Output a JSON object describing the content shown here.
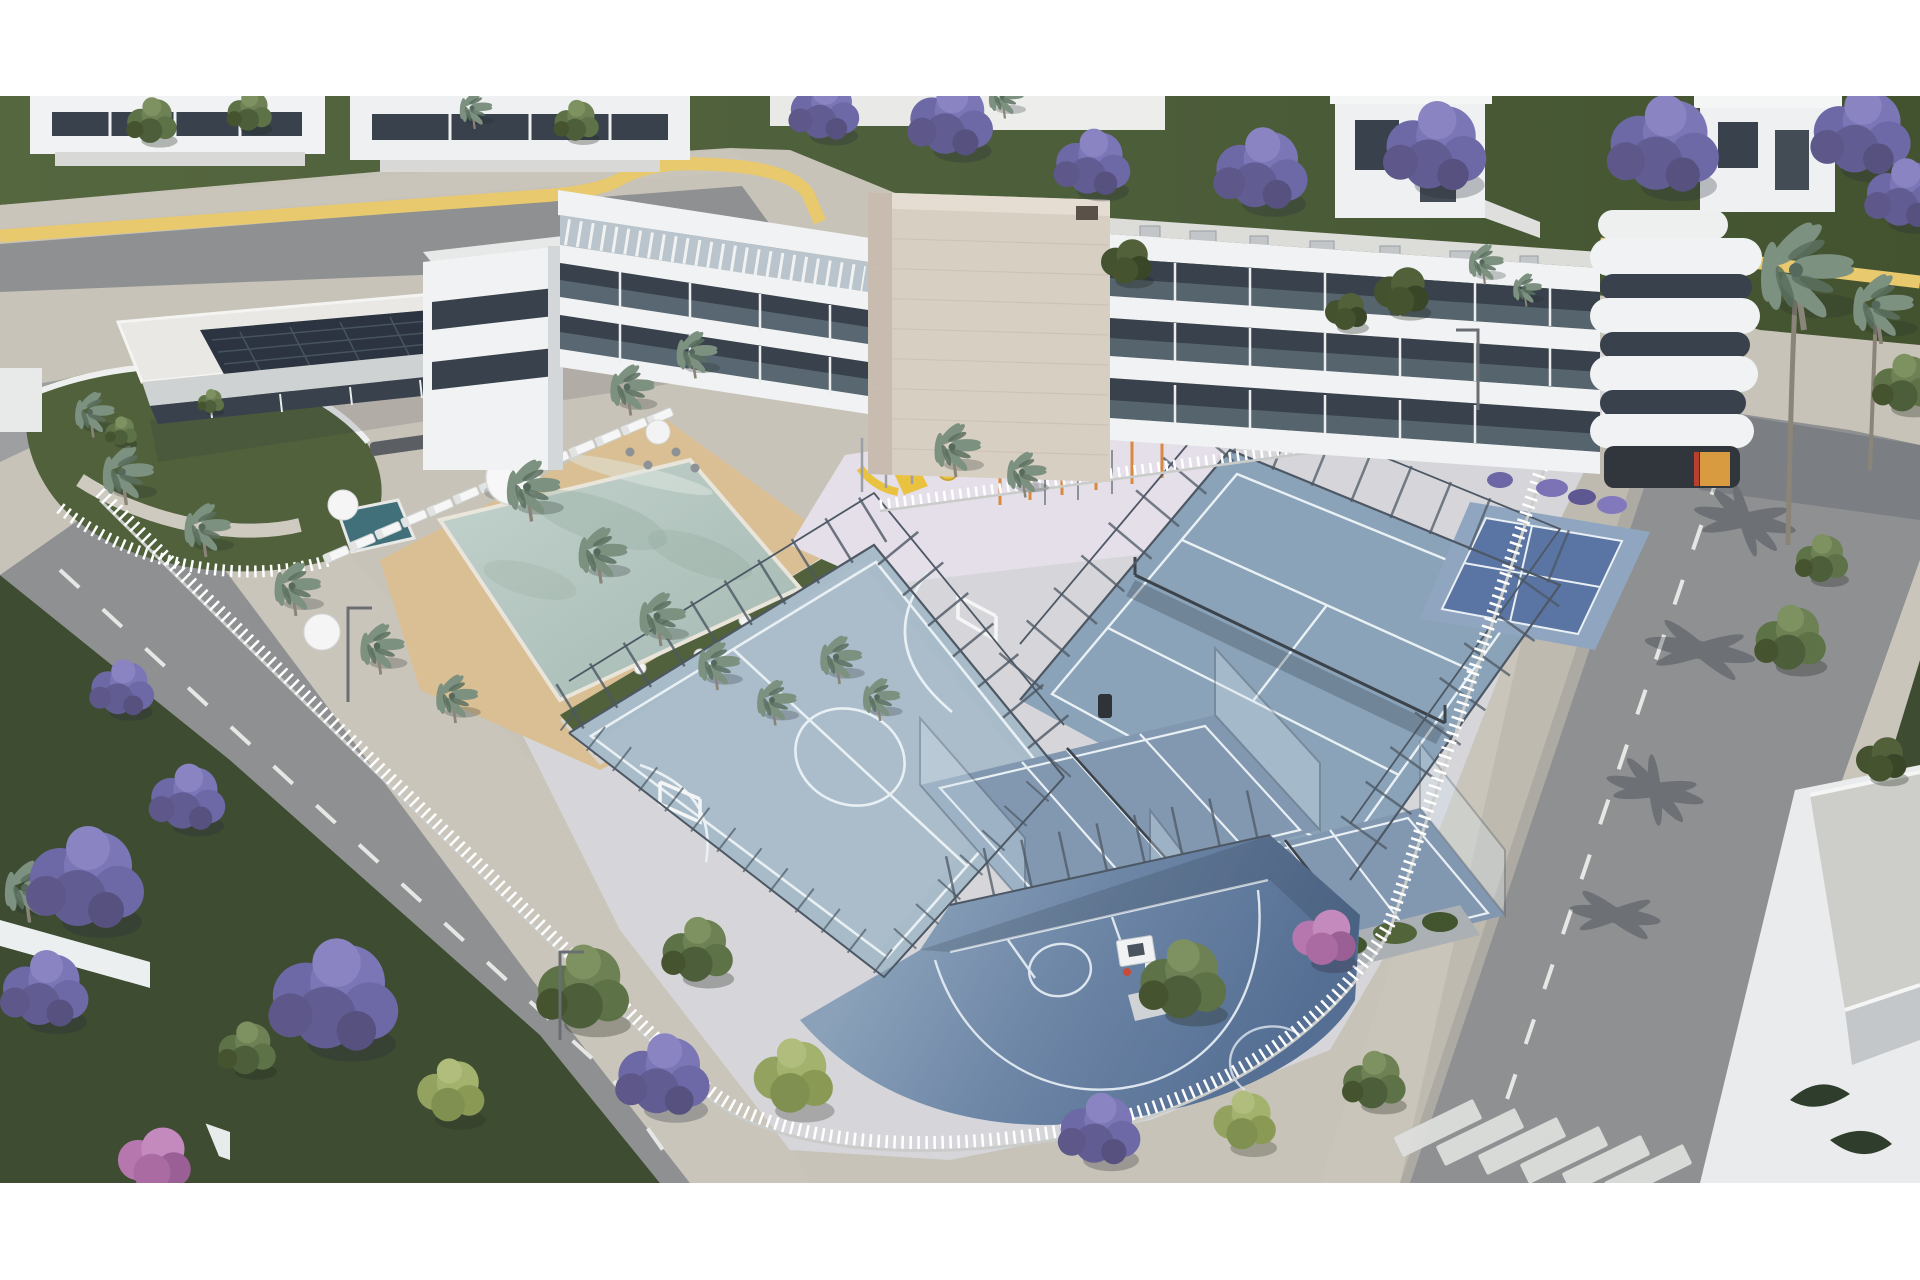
{
  "scene": {
    "description": "Aerial 3D architectural rendering of a modern white residential complex with a central beige stone tower, rooftop solar panels, a landscaped pool garden with palm trees and sun loungers, a playground and outdoor gym, multi-sport courts (futsal, tennis, padel, pickleball, basketball), perimeter white fences, and surrounding streets lined with purple jacaranda trees",
    "time_of_day": "daytime",
    "view": "oblique aerial"
  },
  "palette": {
    "margin": "#ffffff",
    "plaza": "#c8c3b8",
    "sidewalk": "#cac5bb",
    "asphalt": "#8e9092",
    "asphalt_dark": "#828487",
    "lawn": "#50613c",
    "grass_dark": "#3e4c32",
    "yellow_stripe": "#e8c96d",
    "pool_water": "#b5c6c1",
    "pool_deck": "#d9bf93",
    "spa": "#41707a",
    "futsal": "#a8bbc9",
    "tennis": "#8ba3b8",
    "padel": "#8298b0",
    "pickleball": "#5a74a4",
    "pickleball_border": "#90a6c0",
    "basketball_light": "#8aa1b9",
    "basketball_dark": "#556f94",
    "court_line": "#e9f0f4",
    "sports_paving": "#d6d6da",
    "playground_paving": "#e4dfe9",
    "building": "#f0f2f3",
    "facade_band": "#e3e6e8",
    "glass": "#39424c",
    "tower": "#d8cfc3",
    "solar": "#2b3440",
    "fence": "#eef0f0",
    "mesh": "#4d5864",
    "palm": "#7d9180",
    "jacaranda": "#6d68a6",
    "tree_green": "#5d7247",
    "tree_light": "#93a35f",
    "tree_magenta": "#b577ae",
    "slide": "#e9c23f",
    "gym_orange": "#d98a3f",
    "shop_amber": "#d99b3f",
    "roof_gravel": "#cdcec9"
  },
  "inventory": [
    "apartment-building",
    "stone-tower",
    "rounded-corner-balconies",
    "solar-roof-annex",
    "swimming-pool",
    "spa-pool",
    "sun-loungers",
    "pool-umbrellas",
    "palm-trees",
    "garden-terrace-tables",
    "playground",
    "outdoor-gym",
    "futsal-court",
    "tennis-court",
    "padel-court-1",
    "padel-court-2",
    "pickleball-court",
    "basketball-court",
    "perimeter-fence",
    "court-fencing",
    "curved-garden",
    "top-street-row-houses",
    "yellow-traffic-stripe",
    "left-street",
    "right-street",
    "crosswalk",
    "jacaranda-trees",
    "green-trees",
    "magenta-tree",
    "corner-retail-light",
    "bottom-right-building",
    "garden-walls"
  ]
}
